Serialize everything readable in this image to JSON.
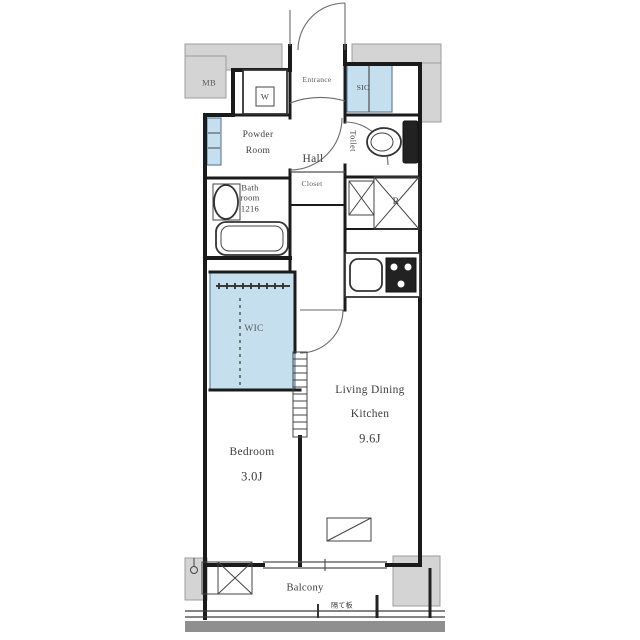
{
  "title": "apartment-floor-plan",
  "colors": {
    "wall": "#1b1b1b",
    "structure_gray": "#d4d4d4",
    "gray_stroke": "#9c9c9c",
    "closet_blue": "#c6dfee",
    "blue_stroke": "#5f85a0",
    "line": "#4f4f4f"
  },
  "labels": {
    "mb": "MB",
    "washer": "W",
    "entrance": "Entrance",
    "shoe_closet": "SIC",
    "powder_line1": "Powder",
    "powder_line2": "Room",
    "hall": "Hall",
    "closet": "Closet",
    "toilet": "Toilet",
    "bath_line1": "Bath",
    "bath_line2": "room",
    "bath_line3": "1216",
    "refrigerator": "R",
    "wic": "WIC",
    "bedroom_name": "Bedroom",
    "bedroom_size": "3.0J",
    "ldk_line1": "Living Dining",
    "ldk_line2": "Kitchen",
    "ldk_size": "9.6J",
    "balcony": "Balcony",
    "partition": "隔て板"
  }
}
